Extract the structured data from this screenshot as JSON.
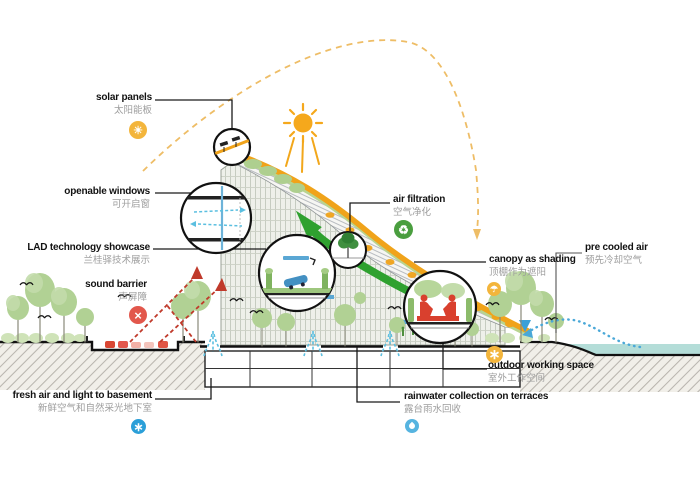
{
  "labels": {
    "solar_panels": {
      "en": "solar panels",
      "zh": "太阳能板"
    },
    "openable_windows": {
      "en": "openable windows",
      "zh": "可开启窗"
    },
    "lad_showcase": {
      "en": "LAD technology showcase",
      "zh": "兰桂驿技术展示"
    },
    "sound_barrier": {
      "en": "sound barrier",
      "zh": "声屏障"
    },
    "air_filtration": {
      "en": "air filtration",
      "zh": "空气净化"
    },
    "canopy_shading": {
      "en": "canopy as shading",
      "zh": "顶棚作为遮阳"
    },
    "pre_cooled_air": {
      "en": "pre cooled air",
      "zh": "预先冷却空气"
    },
    "outdoor_working": {
      "en": "outdoor working space",
      "zh": "室外工作空间"
    },
    "rainwater": {
      "en": "rainwater collection on terraces",
      "zh": "露台雨水回收"
    },
    "fresh_air_basement": {
      "en": "fresh air and light to basement",
      "zh": "新鲜空气和自然采光地下室"
    }
  },
  "icons": {
    "solar": {
      "glyph": "☀"
    },
    "sound_barrier": {
      "glyph": "×"
    },
    "air_filtration": {
      "glyph": "♻"
    },
    "canopy": {
      "glyph": "☂"
    },
    "outdoor": {
      "glyph": "∗"
    },
    "fresh_air": {
      "glyph": "∗"
    }
  },
  "colors": {
    "canopy_orange": "#f0a31a",
    "sun_yellow": "#f5a81c",
    "arrow_green": "#2fa12f",
    "water_teal": "#b4ddd8",
    "car_red": "#d9452e",
    "air_cyan": "#5bbfe0",
    "basement_blue": "#2b9fd8",
    "icon_yellow": "#f3b53c",
    "icon_green": "#4a9e3f"
  }
}
